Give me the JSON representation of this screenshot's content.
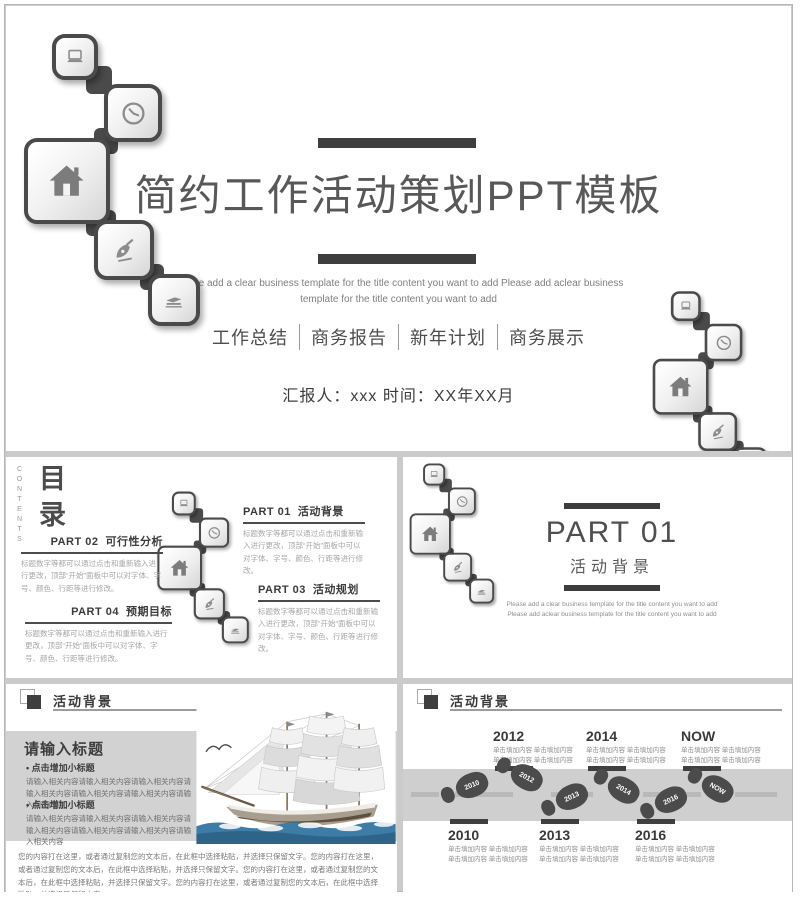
{
  "colors": {
    "accent_dark": "#3e3e3e",
    "chain_border": "#4a4a4a",
    "panel_gray": "#d2d2d2",
    "road_gray": "#cfcfcf",
    "footprint_gray": "#4b4b4b",
    "sea_blue": "#3c7ca6"
  },
  "title_slide": {
    "title": "简约工作活动策划PPT模板",
    "subtitle": "Please add a clear business template for the title content you want to add  Please add aclear business template for the title content you want to add",
    "tags": [
      "工作总结",
      "商务报告",
      "新年计划",
      "商务展示"
    ],
    "reporter": "汇报人：xxx   时间：XX年XX月"
  },
  "contents_slide": {
    "eyebrow": "CONTENTS",
    "title": "目录",
    "parts": [
      {
        "num": "PART 01",
        "name": "活动背景",
        "desc": "标题数字等都可以通过点击和重新输入进行更改，顶部“开始”面板中可以对字体、字号、颜色、行距等进行修改。"
      },
      {
        "num": "PART 02",
        "name": "可行性分析",
        "desc": "标题数字等都可以通过点击和重新输入进行更改，顶部“开始”面板中可以对字体、字号、颜色、行距等进行修改。"
      },
      {
        "num": "PART 03",
        "name": "活动规划",
        "desc": "标题数字等都可以通过点击和重新输入进行更改，顶部“开始”面板中可以对字体、字号、颜色、行距等进行修改。"
      },
      {
        "num": "PART 04",
        "name": "预期目标",
        "desc": "标题数字等都可以通过点击和重新输入进行更改，顶部“开始”面板中可以对字体、字号、颜色、行距等进行修改。"
      }
    ]
  },
  "part_slide": {
    "number": "PART 01",
    "name": "活动背景",
    "subtitle": "Please add a clear business template for the title content you want to add  Please add aclear business template for the title content you want to add"
  },
  "ship_slide": {
    "header": "活动背景",
    "panel_title": "请输入标题",
    "bullets": [
      {
        "heading": "点击增加小标题",
        "body": "请输入相关内容请输入相关内容请输入相关内容请输入相关内容请输入相关内容请输入相关内容请输入相关内容"
      },
      {
        "heading": "点击增加小标题",
        "body": "请输入相关内容请输入相关内容请输入相关内容请输入相关内容请输入相关内容请输入相关内容请输入相关内容"
      }
    ],
    "paragraph": "您的内容打在这里，或者通过复制您的文本后，在此框中选择粘贴，并选择只保留文字。您的内容打在这里，或者通过复制您的文本后，在此框中选择粘贴，并选择只保留文字。您的内容打在这里，或者通过复制您的文本后，在此框中选择粘贴，并选择只保留文字。您的内容打在这里，或者通过复制您的文本后，在此框中选择粘贴，并选择只保留文字。"
  },
  "timeline_slide": {
    "header": "活动背景",
    "top": [
      {
        "year": "2012",
        "note": "单击填加内容  单击填加内容\n单击填加内容  单击填加内容"
      },
      {
        "year": "2014",
        "note": "单击填加内容  单击填加内容\n单击填加内容  单击填加内容"
      },
      {
        "year": "NOW",
        "note": "单击填加内容  单击填加内容\n单击填加内容  单击填加内容"
      }
    ],
    "bottom": [
      {
        "year": "2010",
        "note": "单击填加内容  单击填加内容\n单击填加内容  单击填加内容"
      },
      {
        "year": "2013",
        "note": "单击填加内容  单击填加内容\n单击填加内容  单击填加内容"
      },
      {
        "year": "2016",
        "note": "单击填加内容  单击填加内容\n单击填加内容  单击填加内容"
      }
    ],
    "footprints": [
      "2010",
      "2012",
      "2013",
      "2014",
      "2016",
      "NOW"
    ]
  }
}
